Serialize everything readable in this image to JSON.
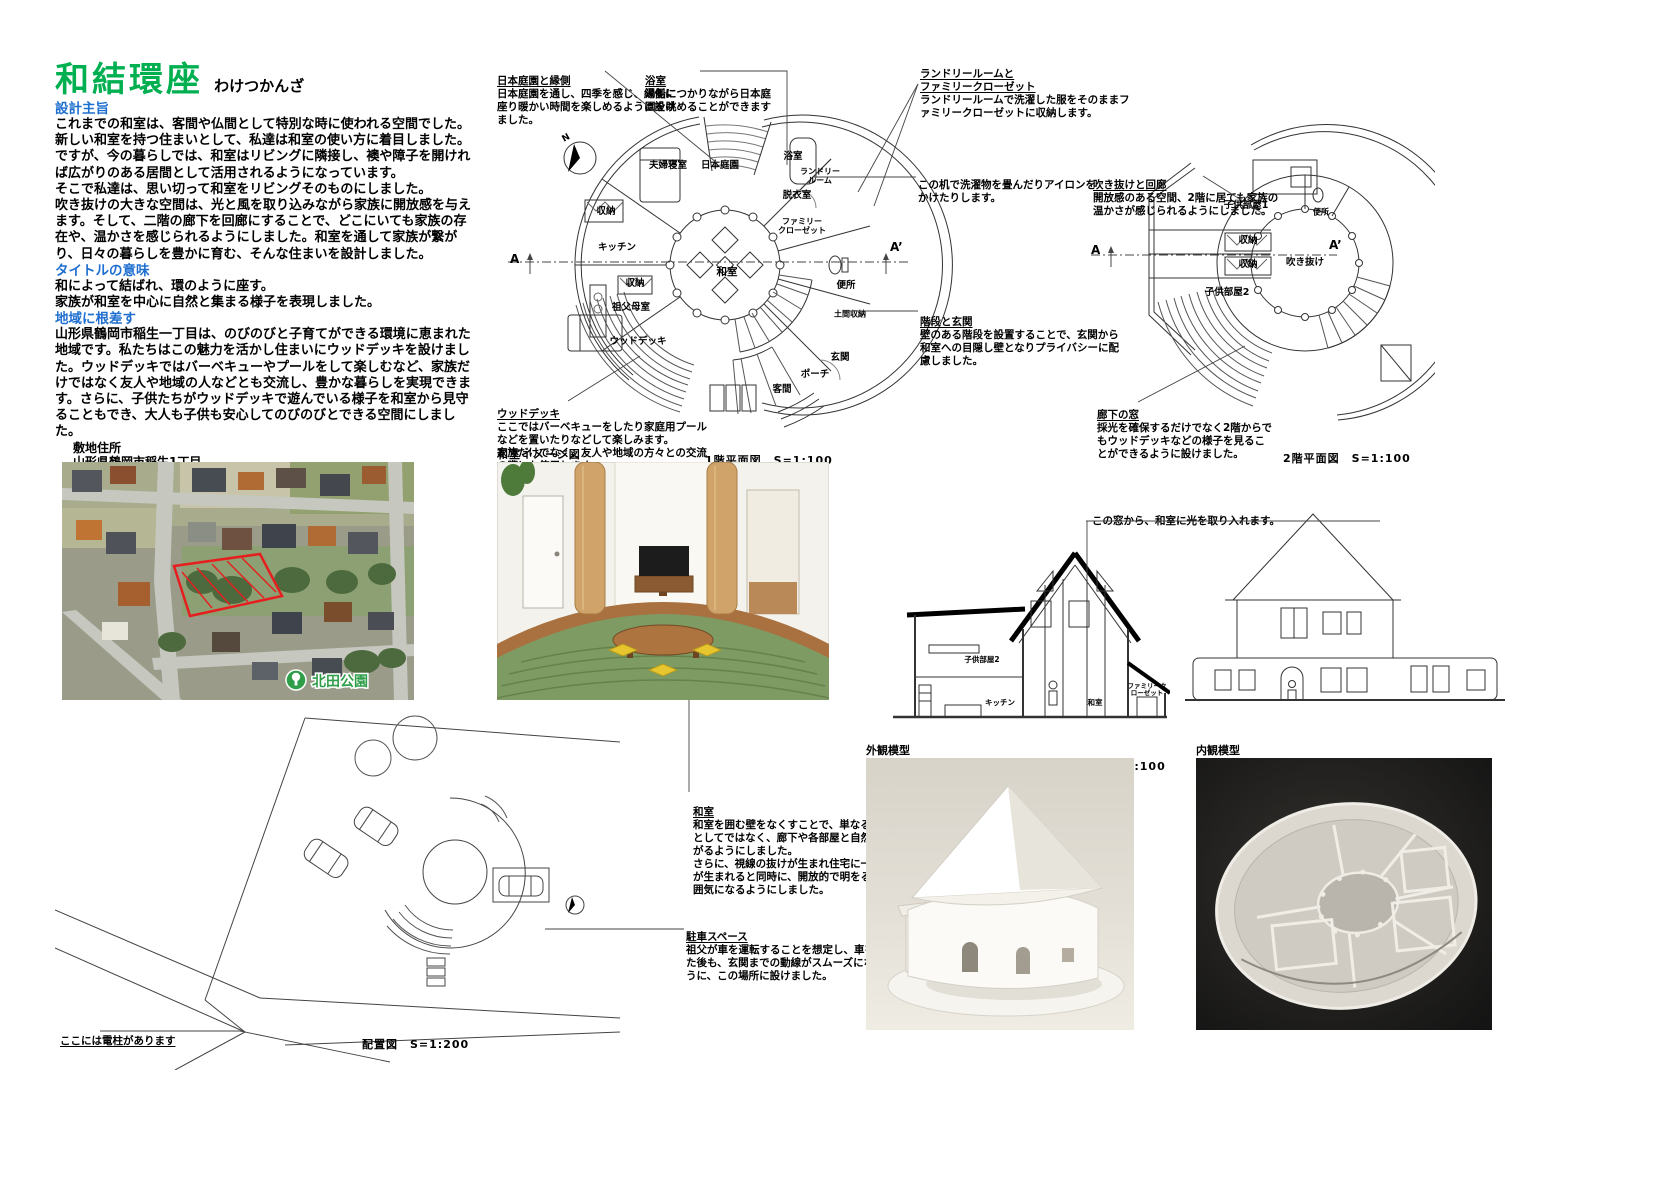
{
  "title": {
    "main": "和結環座",
    "ruby": "わけつかんざ"
  },
  "sections": {
    "s1_heading": "設計主旨",
    "s1_body": "これまでの和室は、客間や仏間として特別な時に使われる空間でした。\n新しい和室を持つ住まいとして、私達は和室の使い方に着目しました。\nですが、今の暮らしでは、和室はリビングに隣接し、襖や障子を開ければ広がりのある居間として活用されるようになっています。\nそこで私達は、思い切って和室をリビングそのものにしました。\n吹き抜けの大きな空間は、光と風を取り込みながら家族に開放感を与えます。そして、二階の廊下を回廊にすることで、どこにいても家族の存在や、温かさを感じられるようにしました。和室を通して家族が繋がり、日々の暮らしを豊かに育む、そんな住まいを設計しました。",
    "s2_heading": "タイトルの意味",
    "s2_body": "和によって結ばれ、環のように座す。\n家族が和室を中心に自然と集まる様子を表現しました。",
    "s3_heading": "地域に根差す",
    "s3_body": "山形県鶴岡市稲生一丁目は、のびのびと子育てができる環境に恵まれた地域です。私たちはこの魅力を活かし住まいにウッドデッキを設けました。ウッドデッキではバーベキューやプールをして楽しむなど、家族だけではなく友人や地域の人などとも交流し、豊かな暮らしを実現できます。さらに、子供たちがウッドデッキで遊んでいる様子を和室から見守ることもでき、大人も子供も安心してのびのびとできる空間にしました。"
  },
  "site_info": {
    "address_label": "敷地住所",
    "address": "山形県鶴岡市稲生1丁目",
    "surroundings_label": "周辺の環境",
    "surroundings_label2": "周辺の環境",
    "surroundings": [
      "・目の前に道路があります",
      "・道路を挟んだ先に公園があります。",
      "・鶴岡市立朝暘第四小学校まで徒歩６分"
    ],
    "family_label": "家族構成",
    "family": "祖父、祖母、父、母、兄、妹",
    "scale_label": "規模",
    "area_rows": [
      {
        "c1": "敷地面積",
        "v1": "502㎡",
        "c2": "1階床面積",
        "v2": "120㎡"
      },
      {
        "c1": "建築面積",
        "v1": "142㎡",
        "c2": "2階床面積",
        "v2": "31㎡"
      },
      {
        "c1": "延べ面積",
        "v1": "151㎡",
        "c2": "",
        "v2": ""
      }
    ]
  },
  "aerial": {
    "park_label": "北田公園"
  },
  "plan1f": {
    "caption": "1階平面図　S=1:100",
    "north_label": "N",
    "mark_a": "A",
    "mark_a2": "A’",
    "rooms": [
      "夫婦寝室",
      "日本庭園",
      "浴室",
      "ランドリー\nルーム",
      "脱衣室",
      "収納",
      "キッチン",
      "和室",
      "収納",
      "祖父母室",
      "ウッドデッキ",
      "ファミリー\nクローゼット",
      "便所",
      "土間収納",
      "玄関",
      "客間",
      "ポーチ"
    ],
    "notes": {
      "garden_title": "日本庭園と縁側",
      "garden_body": "日本庭園を通し、四季を感じ、縁側に座り暖かい時間を楽しめるように設けました。",
      "bath_title": "浴室",
      "bath_body": "湯船につかりながら日本庭園を眺めることができます",
      "laundry_title": "ランドリールームと\nファミリークローゼット",
      "laundry_body": "ランドリールームで洗濯した服をそのままファミリークローゼットに収納します。",
      "desk_body": "この机で洗濯物を畳んだりアイロンをかけたりします。",
      "stair_title": "階段と玄関",
      "stair_body": "壁のある階段を設置することで、玄関から和室への目隠し壁となりプライバシーに配慮しました。",
      "deck_title": "ウッドデッキ",
      "deck_body": "ここではバーベキューをしたり家庭用プールなどを置いたりなどして楽しみます。\n家族だけでなく、友人や地域の方々との交流の際にも使用します。"
    }
  },
  "plan2f": {
    "caption": "2階平面図　S=1:100",
    "mark_a": "A",
    "mark_a2": "A’",
    "rooms": [
      "子供部屋1",
      "収納",
      "収納",
      "子供部屋2",
      "便所",
      "吹き抜け"
    ],
    "notes": {
      "void_title": "吹き抜けと回廊",
      "void_body": "開放感のある空間、2階に居ても家族の温かさが感じられるようにしました。",
      "window_title": "廊下の窓",
      "window_body": "採光を確保するだけでなく2階からでもウッドデッキなどの様子を見ることができるように設けました。"
    }
  },
  "interior_image": {
    "label": "和室イメージ図"
  },
  "notes_mid": {
    "washitsu_title": "和室",
    "washitsu_body": "和室を囲む壁をなくすことで、単なる一室としてではなく、廊下や各部屋と自然と繋がるようにしました。\nさらに、視線の抜けが生まれ住宅に一体感が生まれると同時に、開放的で明をるい雰囲気になるようにしました。",
    "parking_title": "駐車スペース",
    "parking_body": "祖父が車を運転することを想定し、車を降りた後も、玄関までの動線がスムーズになるように、この場所に設けました。"
  },
  "section_drawing": {
    "caption": "A-A’ 断面図　S=1:100",
    "window_note": "この窓から、和室に光を取り入れます。",
    "rooms": [
      "子供部屋2",
      "キッチン",
      "和室",
      "ファミリークローゼット"
    ]
  },
  "elevation": {
    "caption": "南側立面図　S=1:100"
  },
  "site_plan": {
    "caption": "配置図　S=1:200",
    "pole_note": "ここには電柱があります"
  },
  "models": {
    "exterior_label": "外観模型",
    "interior_label": "内観模型"
  },
  "colors": {
    "title_green": "#00b050",
    "heading_blue": "#1f6fd0",
    "site_red": "#e61e1e",
    "park_green": "#2f9e49"
  }
}
